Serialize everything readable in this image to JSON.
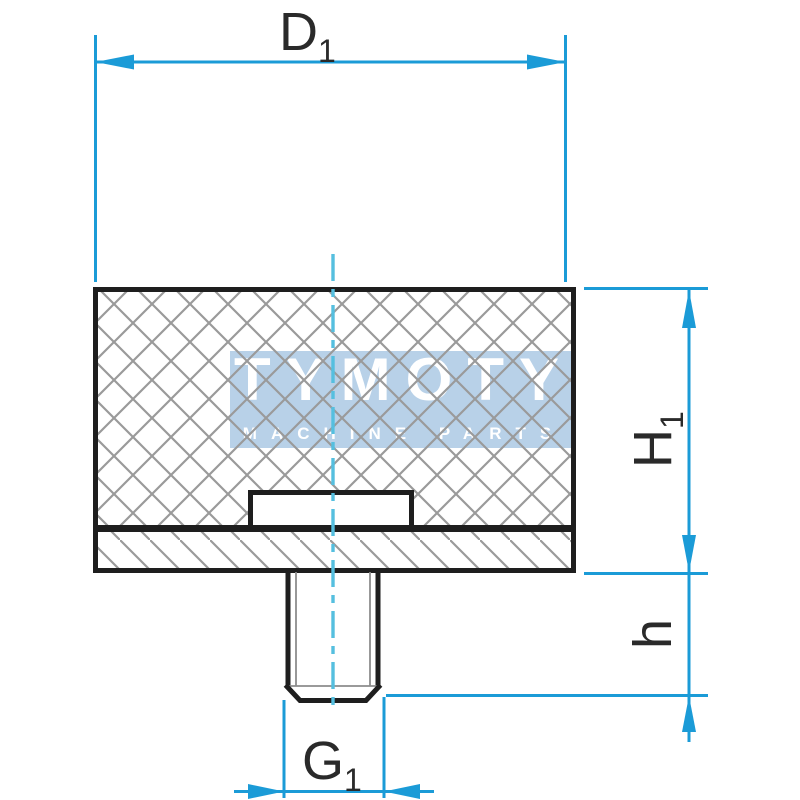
{
  "colors": {
    "background": "#ffffff",
    "outline": "#1e1e1e",
    "hatch": "#9a9a9a",
    "thread": "#8c8c8c",
    "dimension": "#1b9bd7",
    "centerline": "#55bfdf",
    "watermark_band": "#b8d1e8",
    "watermark_text": "#ffffff",
    "label": "#2a2a2a"
  },
  "labels": {
    "diameter": {
      "base": "D",
      "sub": "1"
    },
    "body_height": {
      "base": "H",
      "sub": "1"
    },
    "stud_height": {
      "base": "h"
    },
    "thread": {
      "base": "G",
      "sub": "1"
    }
  },
  "watermark": {
    "brand": "TYMOTY",
    "tagline": "MACHINE PARTS"
  }
}
